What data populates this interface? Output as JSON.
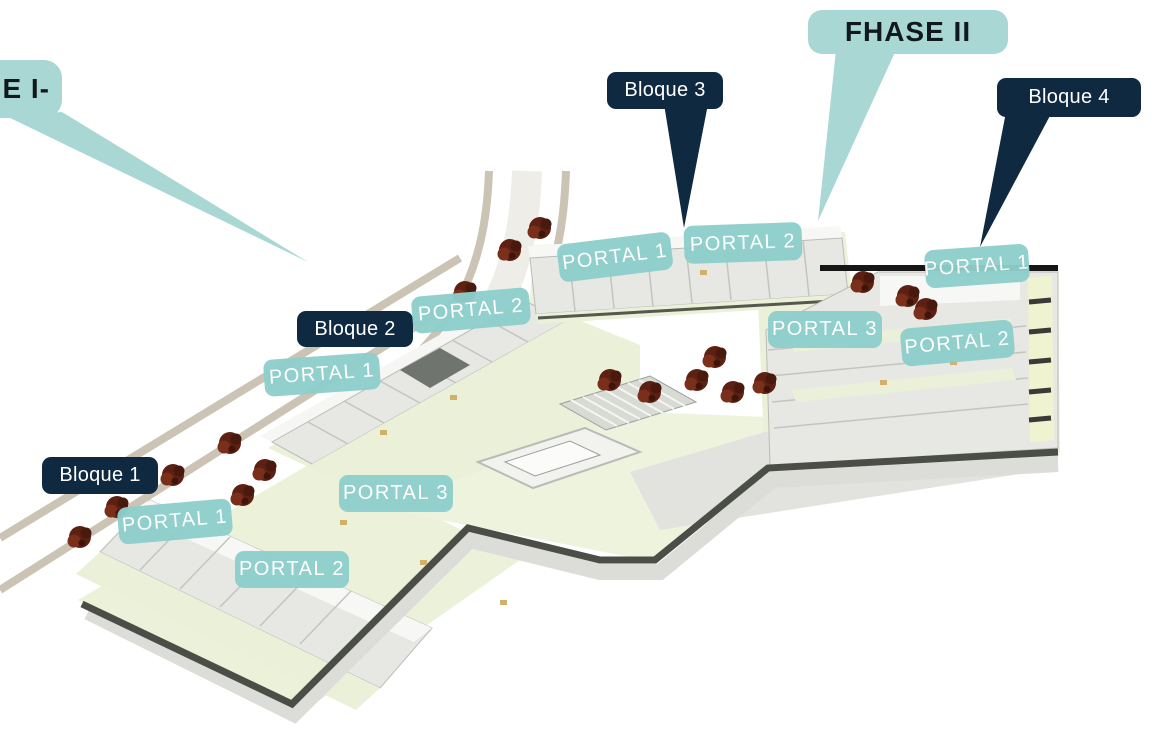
{
  "colors": {
    "teal-bubble": "#a9d8d4",
    "teal-portal": "#8ecfcd",
    "navy": "#0f2940",
    "phase-text": "#12191e",
    "label-text": "#ffffff"
  },
  "site": {
    "phase1": {
      "label": "E I-"
    },
    "phase2": {
      "label": "FHASE II"
    },
    "blocks": [
      {
        "label": "Bloque 1",
        "portals": [
          {
            "label": "PORTAL 1"
          },
          {
            "label": "PORTAL 2"
          },
          {
            "label": "PORTAL 3"
          }
        ]
      },
      {
        "label": "Bloque 2",
        "portals": [
          {
            "label": "PORTAL 1"
          },
          {
            "label": "PORTAL 2"
          }
        ]
      },
      {
        "label": "Bloque 3",
        "portals": [
          {
            "label": "PORTAL 1"
          },
          {
            "label": "PORTAL 2"
          }
        ]
      },
      {
        "label": "Bloque 4",
        "portals": [
          {
            "label": "PORTAL 1"
          },
          {
            "label": "PORTAL 2"
          },
          {
            "label": "PORTAL 3"
          }
        ]
      }
    ]
  }
}
